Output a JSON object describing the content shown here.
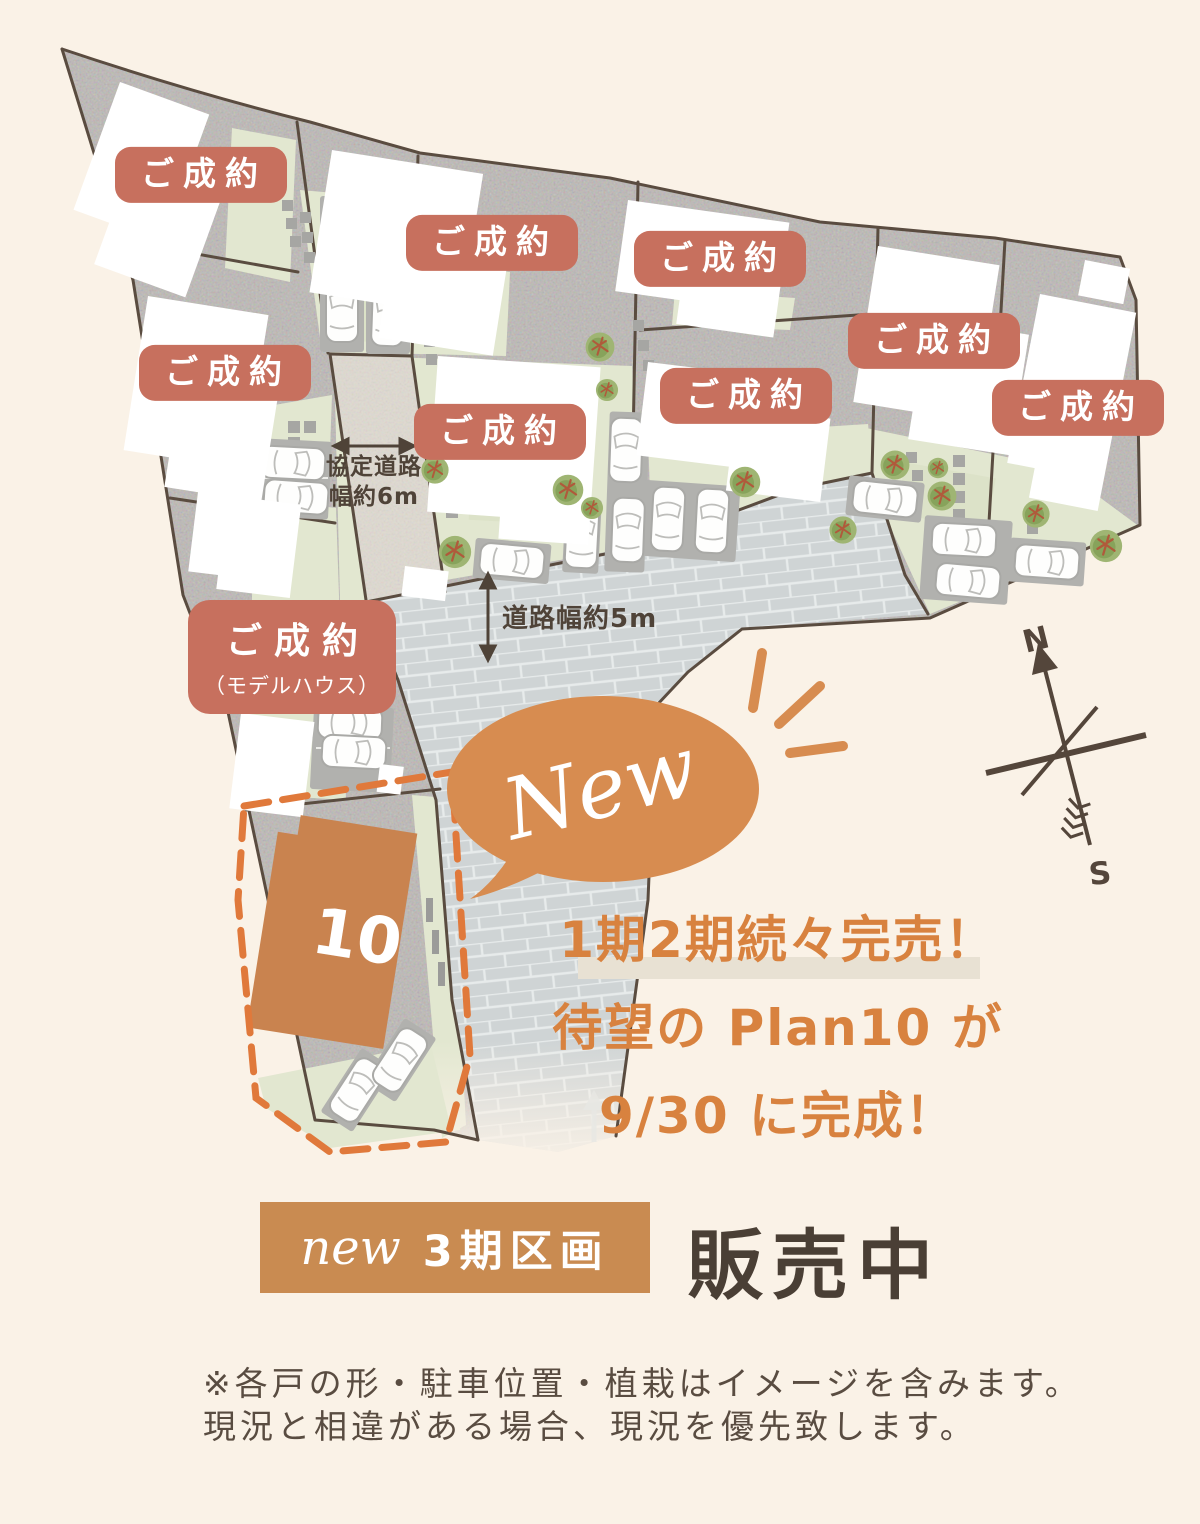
{
  "map": {
    "sold_label": "ご成約",
    "sold_badge_count": 8,
    "model_house_badge": {
      "line1": "ご成約",
      "line2": "（モデルハウス）"
    },
    "lot10_number": "10",
    "road_label_kyotei": {
      "line1": "協定道路",
      "line2": "幅約6m"
    },
    "road_label_width5": "道路幅約5m",
    "new_bubble_label": "New",
    "compass": {
      "north": "N",
      "south": "S"
    }
  },
  "promo": {
    "line1": "1期2期続々完売！",
    "line2": "待望の Plan10 が",
    "line3": "9/30 に完成！"
  },
  "sale_status": {
    "new_script": "new",
    "phase_label": "3期区画",
    "status_label": "販売中"
  },
  "disclaimer": {
    "line1": "※各戸の形・駐車位置・植栽はイメージを含みます。",
    "line2": "現況と相違がある場合、現況を優先致します。"
  },
  "colors": {
    "background": "#FAF2E7",
    "badge_salmon": "#C7705E",
    "promo_orange": "#D8823F",
    "sale_badge_tan": "#C98B51",
    "dark_brown_text": "#4A3F35",
    "map_line_brown": "#5A4C40",
    "lot10_orange": "#C9834F",
    "highlight_dash_orange": "#E0793B",
    "bubble_orange": "#D78C50",
    "lawn_green": "#E2E7D0",
    "brick_road": "#CFD4D5"
  }
}
